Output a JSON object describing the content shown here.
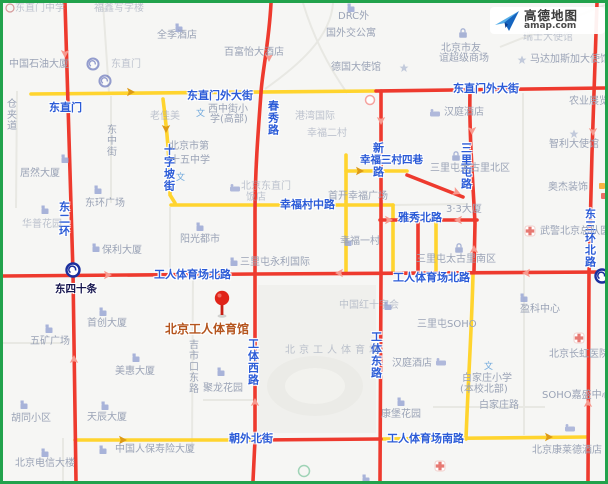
{
  "logo": {
    "brand": "高德地图",
    "domain": "amap.com"
  },
  "traffic_colors": {
    "congested": "#ee3a2e",
    "slow": "#ffd42e",
    "border": "#22a24c"
  },
  "landmark": {
    "name": "北京工人体育馆"
  },
  "roads": {
    "dongzhimenwai": "东直门外大街",
    "chunxiu": "春秀路",
    "shizipo": "十字坡街",
    "xingfucun_mid": "幸福村中路",
    "xindong": "新东路",
    "sanlitun": "三里屯路",
    "xingfu_3c4x": "幸福三村四巷",
    "yaxiu_north": "雅秀北路",
    "gongti_north": "工人体育场北路",
    "gongti_south": "工人体育场南路",
    "gongti_west": "工体西路",
    "gongti_east": "工体东路",
    "dong2huan": "东二环",
    "dong3huan_north": "东三环北路",
    "chaowai_north": "朝外北街",
    "dongzhimen": "东直门",
    "jishikou_east": "吉市口东路",
    "dongzhong": "东中街",
    "cangjiadao": "仓夹道"
  },
  "metro": {
    "dongsishitiao": "东四十条",
    "dongzhimen_station": "东直门"
  },
  "poi": {
    "zhongshiyou": "中国石油大厦",
    "quanji": "全季酒店",
    "baifuyi": "百富怡大酒店",
    "dzm_zhongxue": "东直门中学",
    "fuxin": "福鑫写字楼",
    "drc_l1": "DRC外",
    "drc_l2": "国外交公寓",
    "deguo": "德国大使馆",
    "youyi_l1": "北京市友",
    "youyi_l2": "谊超级商场",
    "madajiasijia": "马达加斯加大使馆",
    "ruishi": "瑞士大使馆",
    "hanting": "汉庭酒店",
    "gangwan": "港湾国际",
    "xingfu2cun": "幸福二村",
    "xizhongjie_l1": "西中街小",
    "xizhongjie_l2": "学(高部)",
    "laojiamei": "老佳美",
    "shiwuzhong_l1": "北京市第",
    "shiwuzhong_l2": "十五中学",
    "juran": "居然大厦",
    "donghuan_plaza": "东环广场",
    "huapu": "华普花园",
    "nongye": "农业展览馆",
    "zhili": "智利大使馆",
    "aojie": "奥杰装饰",
    "wujing": "武警北京总队医院",
    "taikoli_north": "三里屯太古里北区",
    "dasha33": "3·3大厦",
    "xingfu1cun": "幸福一村",
    "shoukai": "首开幸福广场",
    "yangguang": "阳光都市",
    "dzm_hotel_l1": "北京东直门",
    "dzm_hotel_l2": "饭店",
    "baoli": "保利大厦",
    "yongli": "三里屯永利国际",
    "shouchuang": "首创大厦",
    "wukuang": "五矿广场",
    "meihui": "美惠大厦",
    "taikoli_south": "三里屯太古里南区",
    "redcross": "中国红十字会",
    "sanlitun_soho": "三里屯SOHO",
    "yingke": "盈科中心",
    "gongtichang": "北京工人体育场",
    "changhong": "北京长虹医院",
    "baijiazhuang_l1": "白家庄小学",
    "baijiazhuang_l2": "(本校北部)",
    "baijiazhuang_lu": "白家庄路",
    "soho_jiasheng": "SOHO嘉盛中心",
    "kangbao": "康堡花园",
    "julong": "聚龙花园",
    "kanglaide": "北京康莱德酒店",
    "tianchen": "天辰大厦",
    "renbao": "中国人保寿险大厦",
    "dianxin": "北京电信大楼",
    "hutong": "胡同小区",
    "wen_icon": "文"
  }
}
